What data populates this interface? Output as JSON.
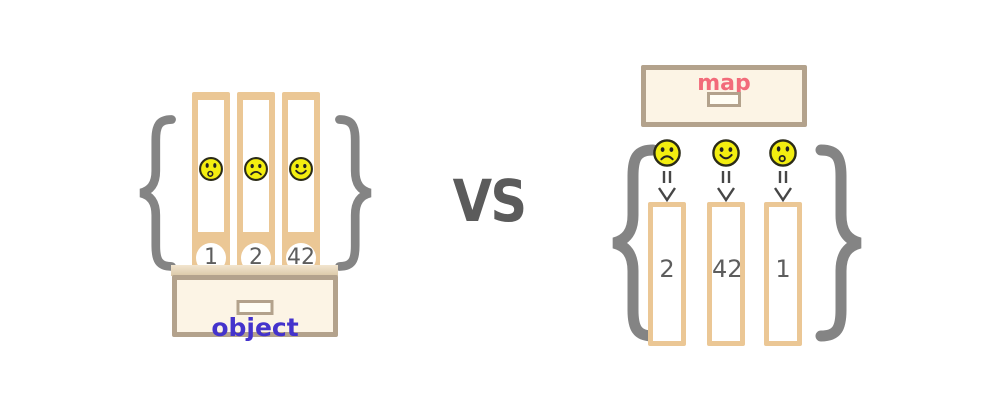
{
  "vs_label": "VS",
  "object": {
    "label": "object",
    "binders": [
      {
        "emoji": "surprised",
        "key": "1"
      },
      {
        "emoji": "sad",
        "key": "2"
      },
      {
        "emoji": "smiley",
        "key": "42"
      }
    ]
  },
  "map": {
    "label": "map",
    "entries": [
      {
        "emoji": "sad",
        "value": "2"
      },
      {
        "emoji": "smiley",
        "value": "42"
      },
      {
        "emoji": "surprised",
        "value": "1"
      }
    ]
  },
  "colors": {
    "tan": "#ebc795",
    "drawer_border": "#b3a28c",
    "drawer_fill": "#fcf4e5",
    "brace_gray": "#848484",
    "vs_gray": "#5b5b5b",
    "object_label": "#4433cc",
    "map_label": "#f26b7a",
    "number_gray": "#5d5d5d",
    "emoji_yellow": "#f3ee10"
  }
}
